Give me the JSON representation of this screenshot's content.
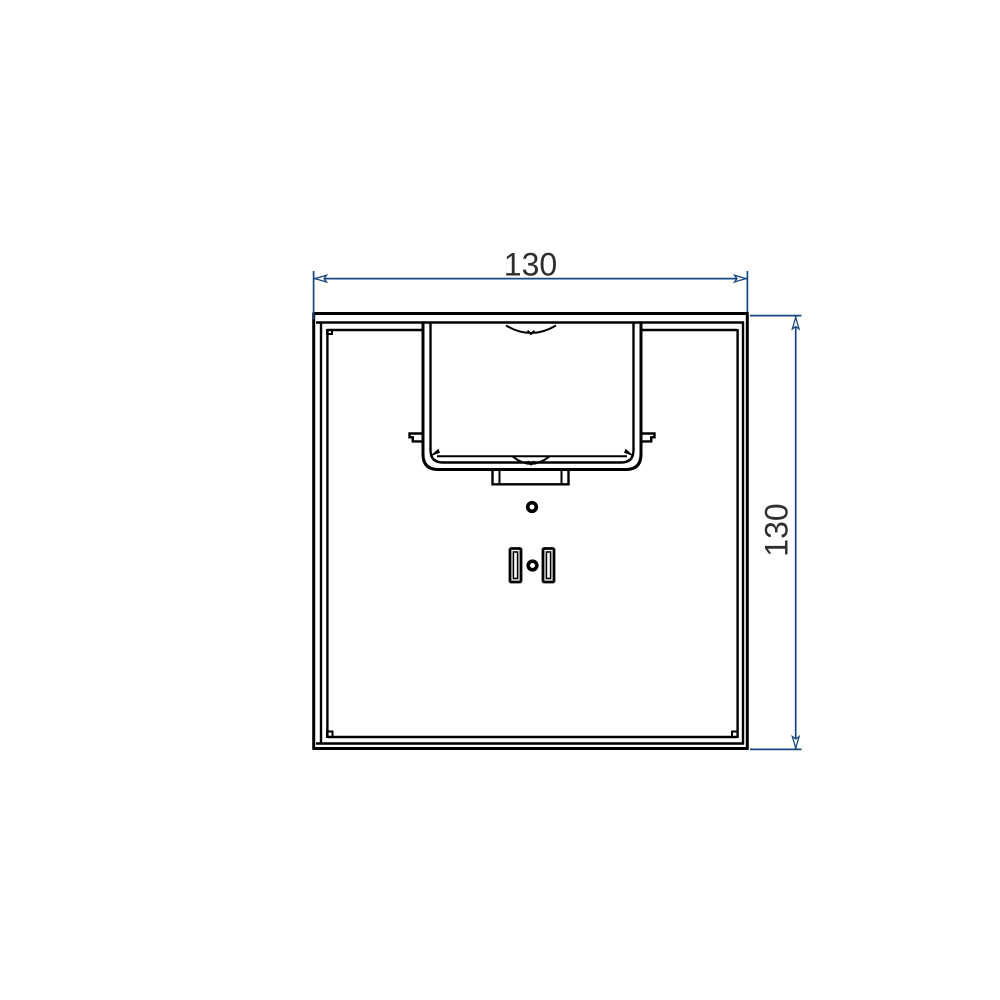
{
  "canvas": {
    "background": "#ffffff",
    "width": 1000,
    "height": 1000
  },
  "colors": {
    "part_line": "#000000",
    "dimension": "#16477e",
    "dim_text": "#2e2e2e"
  },
  "dimensions": {
    "top": {
      "value": "130",
      "orientation": "horizontal"
    },
    "right": {
      "value": "130",
      "orientation": "vertical"
    }
  },
  "features": {
    "outline": "square-profile-frame",
    "pocket": "central-rectangular-pocket",
    "notch": "finger-notch-arc",
    "tabs": "side-latch-tabs",
    "holes": "center-hole-pair",
    "slots": "vertical-slot-pair"
  }
}
